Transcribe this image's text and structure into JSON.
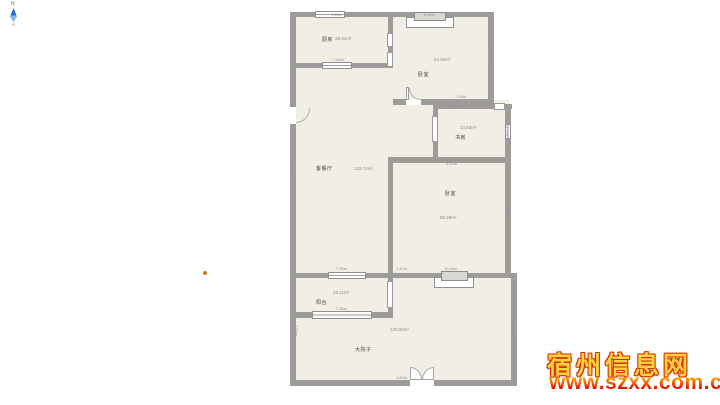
{
  "compass": {
    "north": "N",
    "south": "S",
    "arrow_color": "#1d6fd6"
  },
  "plan": {
    "wall_color": "#9d9c99",
    "floor_color": "#f0eee5",
    "rooms": [
      {
        "name": "厨房",
        "area": "28.91m²"
      },
      {
        "name": "卧室",
        "area": "54.50m²"
      },
      {
        "name": "客餐厅",
        "area": "133.74m²"
      },
      {
        "name": "书房",
        "area": "23.63m²"
      },
      {
        "name": "卧室",
        "area": "80.20m²"
      },
      {
        "name": "阳台",
        "area": "25.11m²"
      },
      {
        "name": "大院子",
        "area": "120.02m²"
      }
    ],
    "dims": [
      "7.69m",
      "5.40m",
      "7.60m",
      "7.26m",
      "5.00m",
      "5.43m",
      "1.41m",
      "10.40m",
      "7.90m",
      "7.90m",
      "1.50m",
      "4.50m",
      "2.95m",
      "5.33m",
      "6.85m",
      "3.30m",
      "4.05m"
    ]
  },
  "watermark": {
    "title": "宿州信息网",
    "url": "www.szxx.com.cn",
    "title_color": "#ffd23e",
    "outline_color": "#d22f00",
    "url_colors": [
      "#ffb400",
      "#e51400"
    ]
  }
}
